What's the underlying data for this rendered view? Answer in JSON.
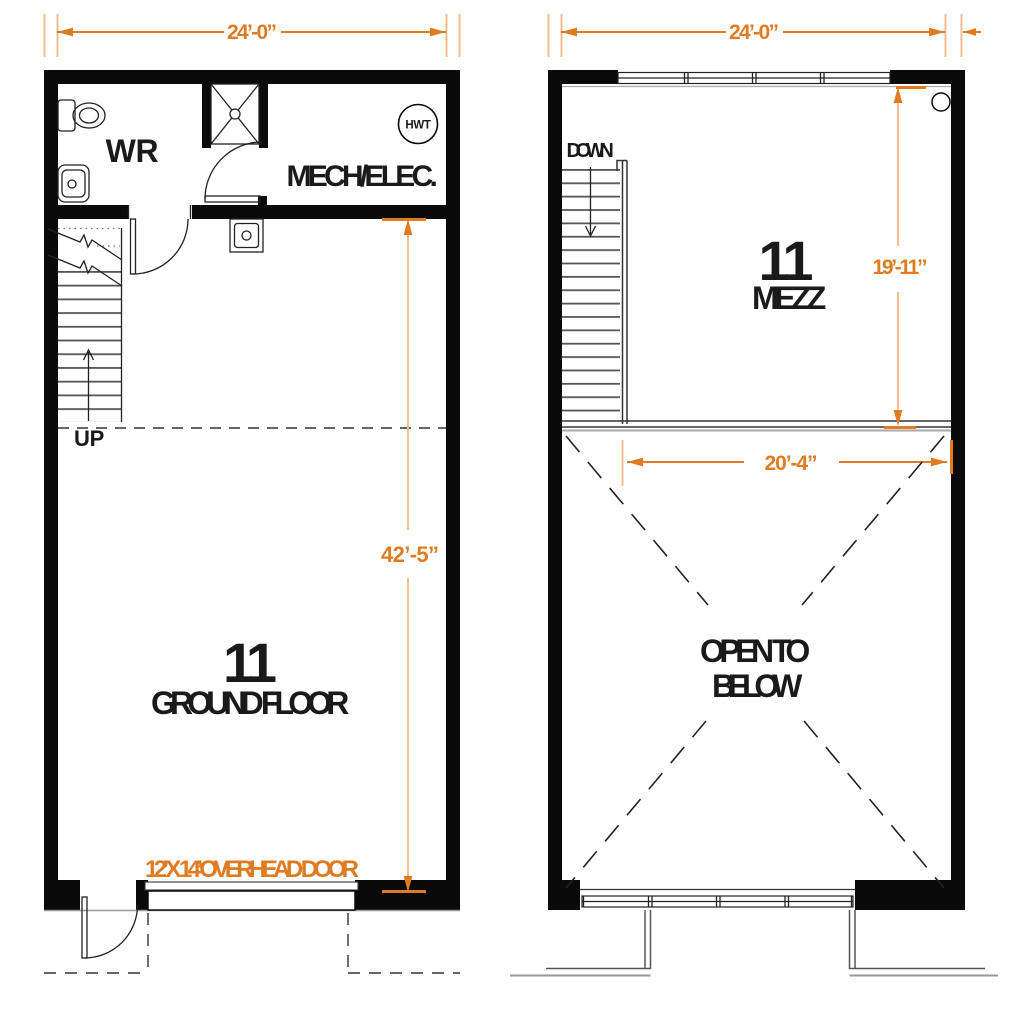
{
  "colors": {
    "dimension_orange": "#E07B21",
    "witness_light_orange": "#F4BE92",
    "wall_black": "#0a0a0a"
  },
  "ground_floor": {
    "width_dim": "24’-0”",
    "depth_dim": "42’-5”",
    "unit_number": "11",
    "level_label": "GROUND FLOOR",
    "wr_label": "WR",
    "mech_label": "MECH/ELEC.",
    "hwt_label": "HWT",
    "up_label": "UP",
    "overhead_door_label": "12’ X 14’ OVERHEAD DOOR"
  },
  "mezzanine": {
    "width_dim": "24’-0”",
    "mezz_depth_dim": "19’-11”",
    "open_width_dim": "20’-4”",
    "unit_number": "11",
    "level_label": "MEZZ",
    "down_label": "DOWN",
    "open_to_below_line1": "OPEN TO",
    "open_to_below_line2": "BELOW"
  }
}
